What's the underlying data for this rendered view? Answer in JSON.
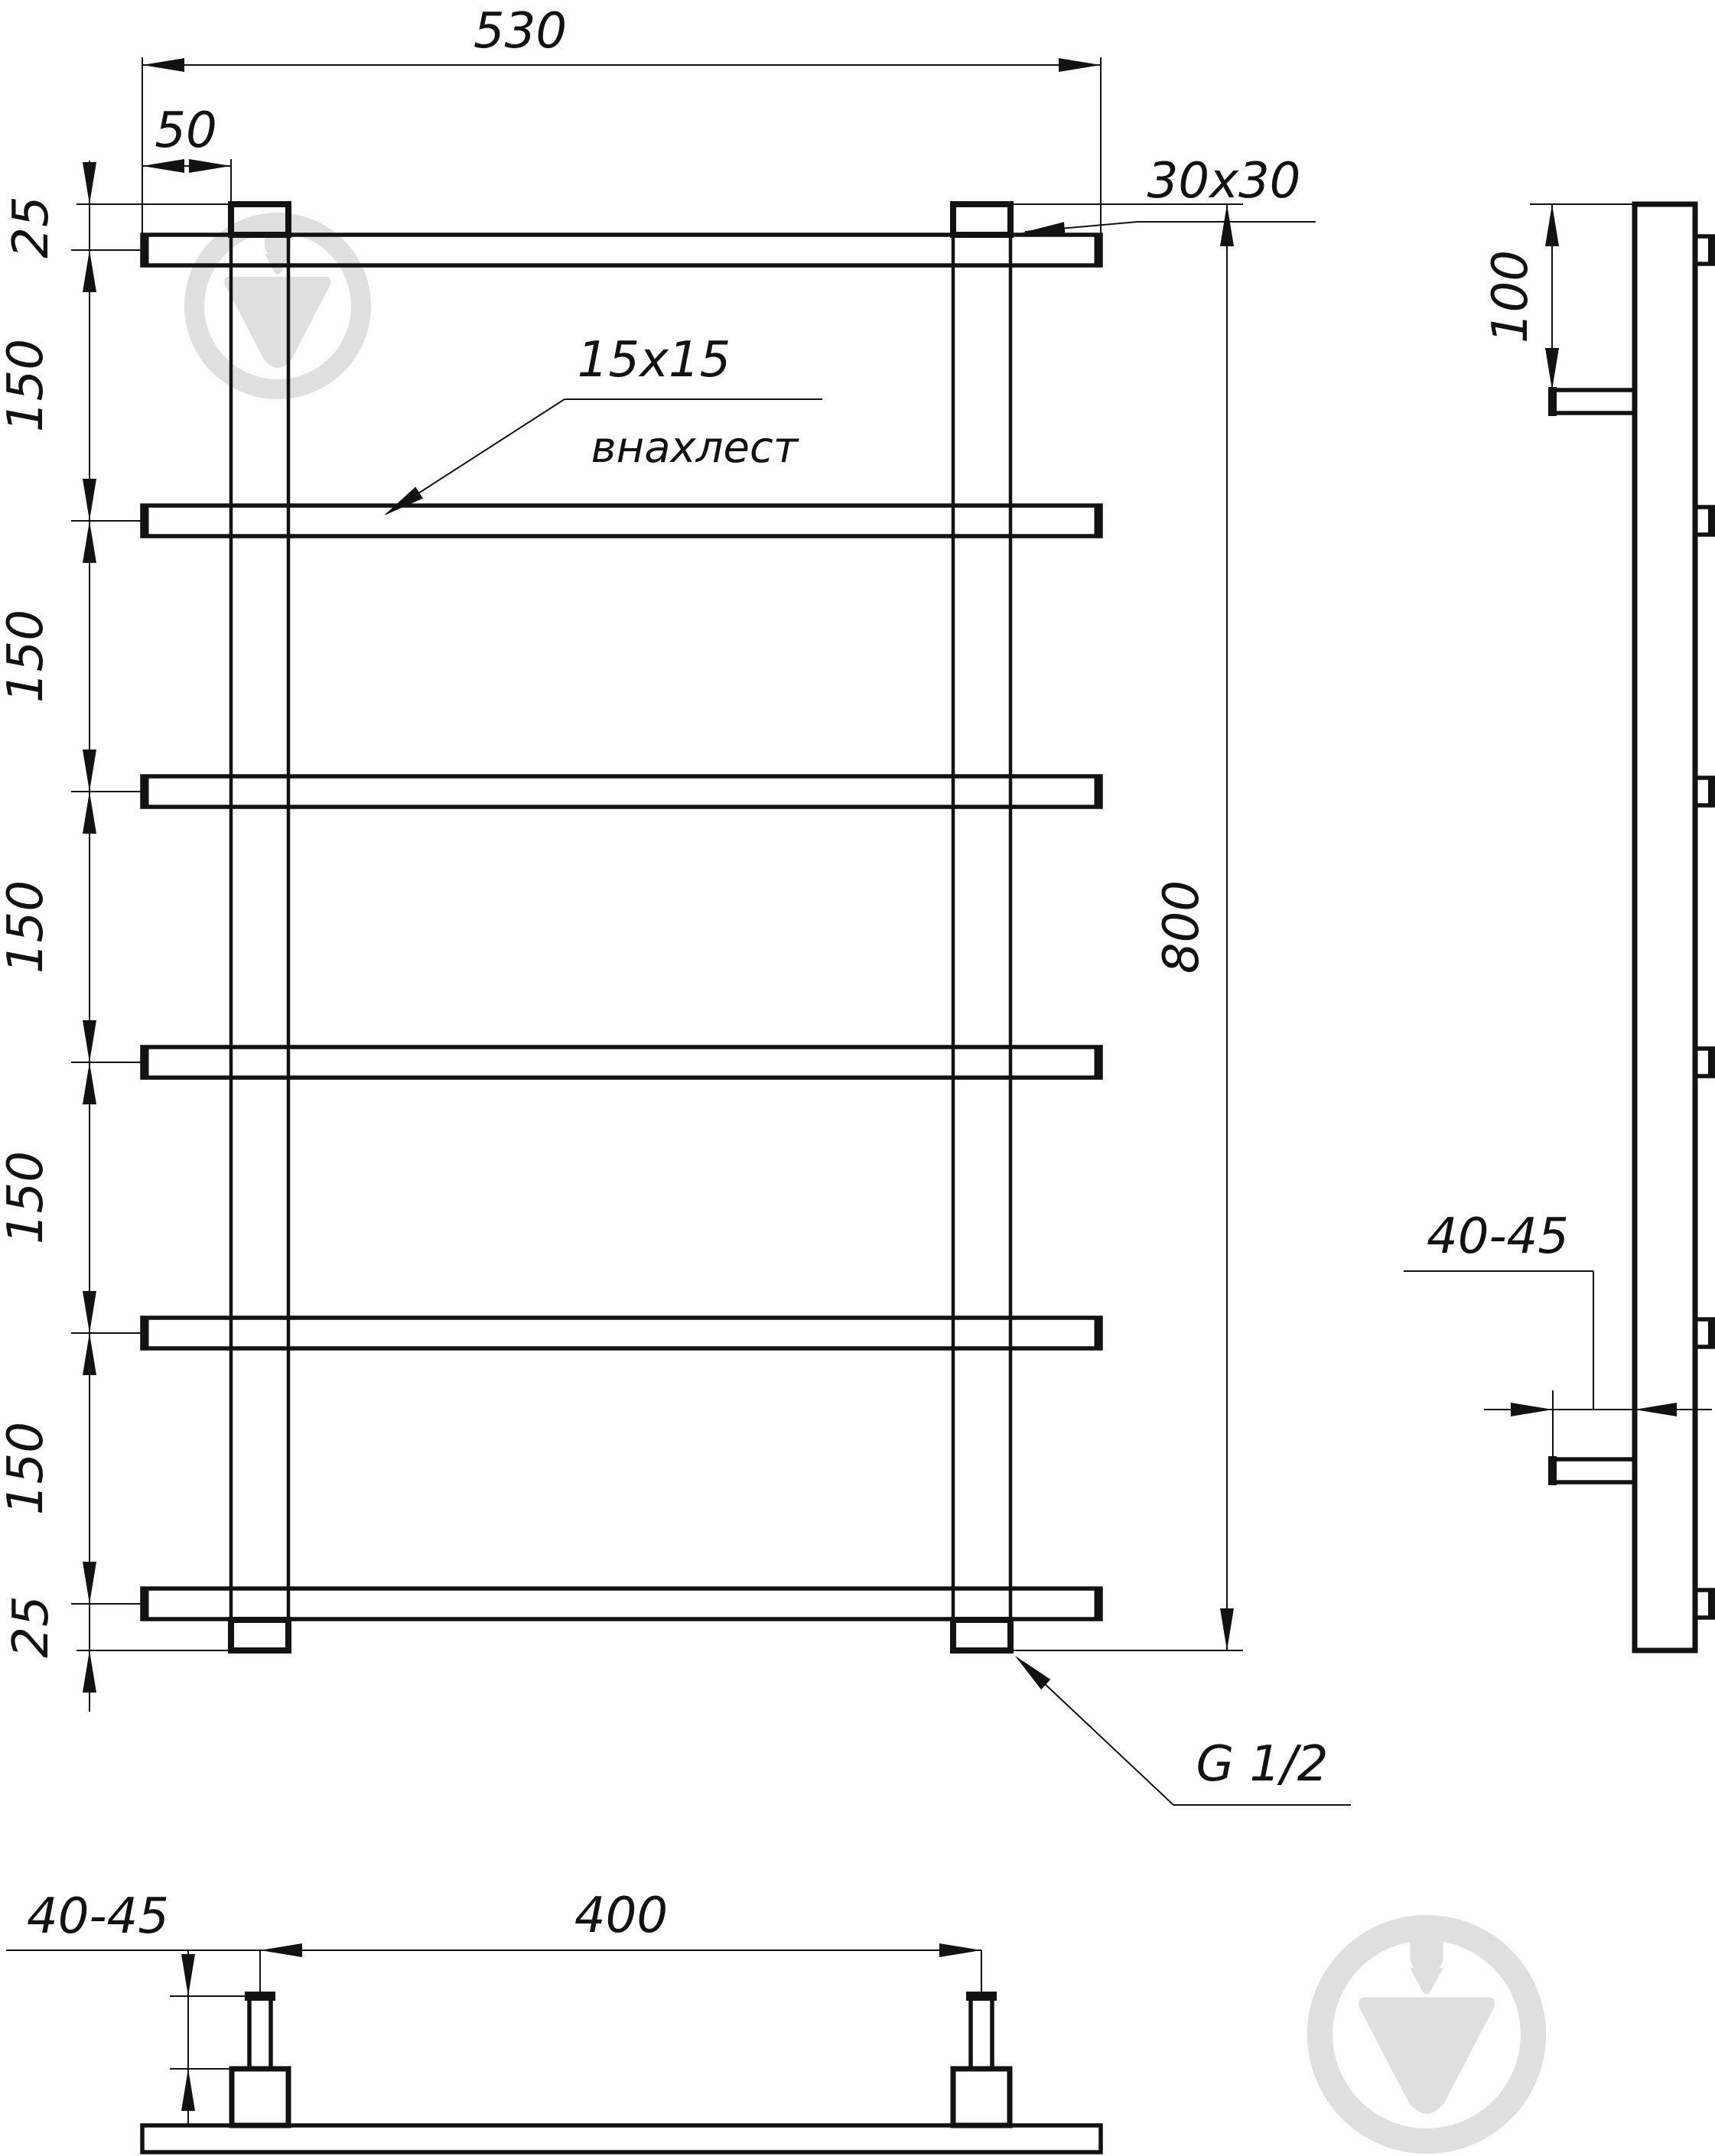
{
  "drawing": {
    "front_view": {
      "overall_width": "530",
      "post_offset": "50",
      "top_overhang": "25",
      "rail_spacings": [
        "150",
        "150",
        "150",
        "150",
        "150"
      ],
      "bottom_overhang": "25",
      "overall_height": "800",
      "post_tube": "30x30",
      "rail_tube": "15x15",
      "rail_overlap": "внахлест",
      "thread": "G 1/2"
    },
    "side_view": {
      "top_bracket_offset": "100",
      "wall_distance": "40-45"
    },
    "bottom_view": {
      "wall_distance": "40-45",
      "bracket_spacing": "400"
    },
    "colors": {
      "line": "#121212",
      "watermark": "#dcdcdc"
    }
  }
}
